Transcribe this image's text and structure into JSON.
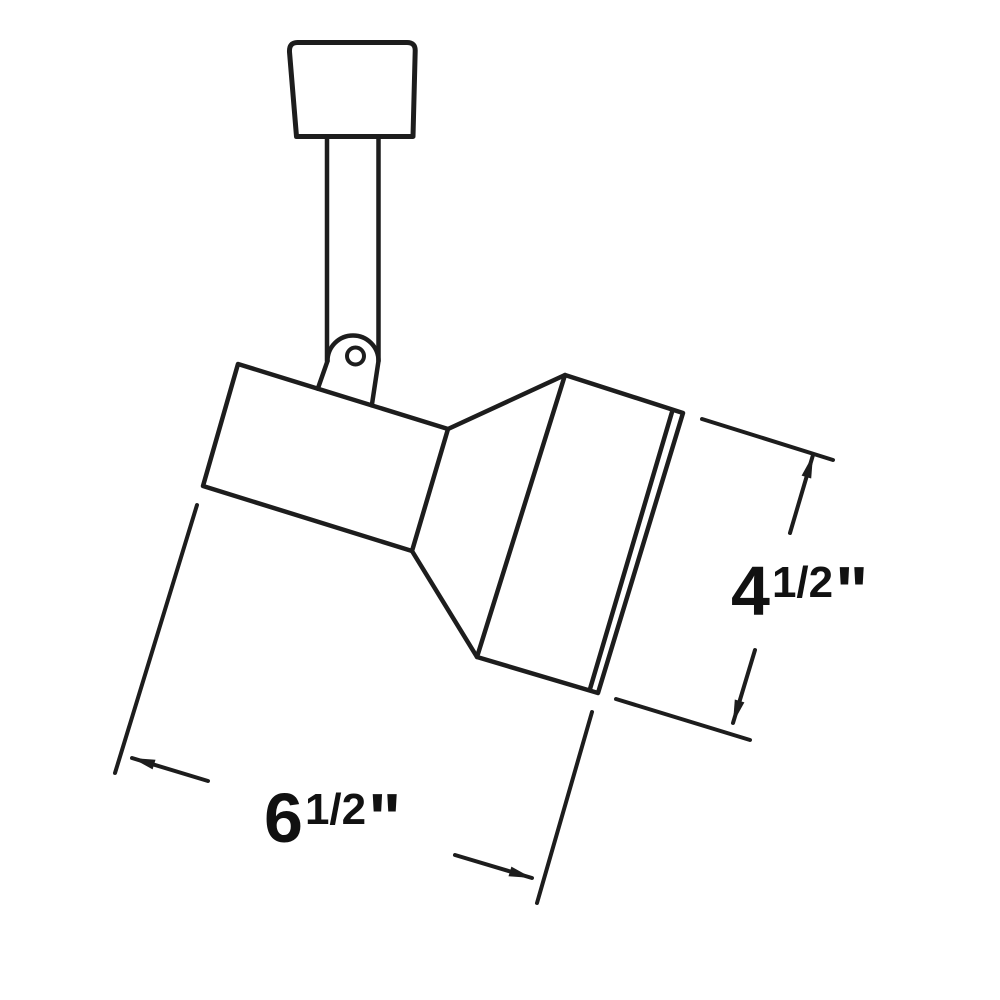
{
  "canvas": {
    "width": 1000,
    "height": 1000,
    "background": "#ffffff",
    "line_color": "#1d1d1d",
    "text_color": "#111111"
  },
  "figure": {
    "description_labels": {
      "height_dimension": "4 1/2\"",
      "length_dimension": "6 1/2\""
    }
  },
  "drawing": {
    "stroke": "#1d1d1d",
    "stroke_width": 4.5,
    "dimension_stroke_width": 4,
    "arrow_length": 23,
    "arrow_half_width": 5,
    "shapes": [
      {
        "type": "path",
        "name": "track-mount-base",
        "d": "M 296.5 136.5 L 289.5 52 Q 289 42.5 297.5 42.5 L 407 42.5 Q 415.5 42.5 415.2 51 L 413 136.5 Z",
        "w": 5
      },
      {
        "type": "line",
        "name": "stem-left-edge",
        "p1": [
          327,
          136.5
        ],
        "p2": [
          327,
          361
        ]
      },
      {
        "type": "line",
        "name": "stem-right-edge",
        "p1": [
          378.5,
          136.5
        ],
        "p2": [
          378.5,
          360
        ]
      },
      {
        "type": "path",
        "name": "pivot-knuckle-cap",
        "d": "M 327.5 361 A 25.5 25.5 0 0 1 378.5 361"
      },
      {
        "type": "line",
        "name": "pivot-knuckle-left-edge",
        "p1": [
          327.5,
          361
        ],
        "p2": [
          317.8,
          388.7
        ]
      },
      {
        "type": "line",
        "name": "pivot-knuckle-right-edge",
        "p1": [
          378.5,
          361
        ],
        "p2": [
          371.8,
          405.4
        ]
      },
      {
        "type": "circle",
        "name": "pivot-pin-hole",
        "c": [
          355.5,
          356
        ],
        "r": 8.5,
        "w": 4
      },
      {
        "type": "polygon",
        "name": "lamp-housing-body",
        "points": [
          [
            238,
            364
          ],
          [
            448,
            429
          ],
          [
            412,
            551
          ],
          [
            203,
            486
          ]
        ]
      },
      {
        "type": "line",
        "name": "flare-top-edge",
        "p1": [
          448,
          429
        ],
        "p2": [
          565,
          375
        ]
      },
      {
        "type": "line",
        "name": "flare-bottom-edge",
        "p1": [
          412,
          551
        ],
        "p2": [
          477,
          657
        ]
      },
      {
        "type": "polygon",
        "name": "lamp-cylinder-body",
        "points": [
          [
            565,
            375
          ],
          [
            683,
            413
          ],
          [
            598,
            693
          ],
          [
            477,
            657
          ]
        ]
      },
      {
        "type": "line",
        "name": "front-rim-inner-line",
        "p1": [
          672,
          412
        ],
        "p2": [
          590,
          689
        ]
      },
      {
        "type": "line",
        "name": "height-ext-line-top",
        "p1": [
          702,
          419
        ],
        "p2": [
          833,
          460
        ],
        "w": 4
      },
      {
        "type": "line",
        "name": "height-ext-line-bottom",
        "p1": [
          616,
          699
        ],
        "p2": [
          750,
          740
        ],
        "w": 4
      },
      {
        "type": "line",
        "name": "height-dim-line-upper",
        "p1": [
          813,
          455
        ],
        "p2": [
          790,
          533
        ],
        "w": 4
      },
      {
        "type": "line",
        "name": "height-dim-line-lower",
        "p1": [
          755,
          650
        ],
        "p2": [
          733,
          723
        ],
        "w": 4
      },
      {
        "type": "arrow",
        "name": "height-arrowhead-top",
        "tip": [
          813,
          455
        ],
        "angle": -73.4
      },
      {
        "type": "arrow",
        "name": "height-arrowhead-bottom",
        "tip": [
          733,
          723
        ],
        "angle": 106.6
      },
      {
        "type": "line",
        "name": "length-ext-line-left",
        "p1": [
          197,
          505
        ],
        "p2": [
          115,
          773
        ],
        "w": 4
      },
      {
        "type": "line",
        "name": "length-ext-line-right",
        "p1": [
          592,
          712
        ],
        "p2": [
          537,
          903
        ],
        "w": 4
      },
      {
        "type": "line",
        "name": "length-dim-line-left",
        "p1": [
          132,
          758
        ],
        "p2": [
          208,
          781
        ],
        "w": 4
      },
      {
        "type": "line",
        "name": "length-dim-line-right",
        "p1": [
          455,
          855
        ],
        "p2": [
          532,
          878
        ],
        "w": 4
      },
      {
        "type": "arrow",
        "name": "length-arrowhead-left",
        "tip": [
          132,
          758
        ],
        "angle": -163.3
      },
      {
        "type": "arrow",
        "name": "length-arrowhead-right",
        "tip": [
          532,
          878
        ],
        "angle": 16.7
      }
    ],
    "labels": [
      {
        "name": "height-dimension-label",
        "x": 731,
        "y": 615,
        "main": "4",
        "frac": "1/2",
        "unit": "\"",
        "main_size": 70,
        "sup_size": 44,
        "sup_rise": 18
      },
      {
        "name": "length-dimension-label",
        "x": 264,
        "y": 842,
        "main": "6",
        "frac": "1/2",
        "unit": "\"",
        "main_size": 70,
        "sup_size": 44,
        "sup_rise": 18
      }
    ]
  }
}
